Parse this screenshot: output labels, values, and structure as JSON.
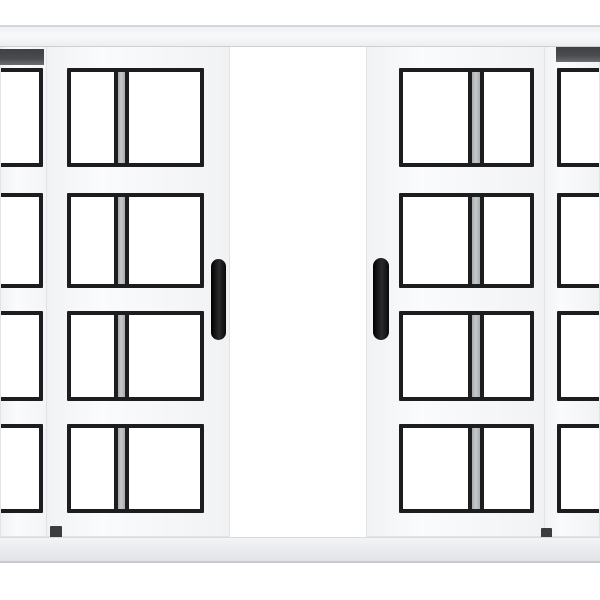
{
  "scene": {
    "kind": "product-photo",
    "description": "White aluminium four-panel sliding window with black square-grid panes, the two centre panels slid open leaving a white gap in the middle",
    "background": "#ffffff"
  },
  "colors": {
    "frame": "#f5f6f8",
    "frame_edge": "#e1e3e6",
    "grid": "#1d1d1f",
    "glass": "#ffffff",
    "rear_stile_gray": "#b7babd",
    "top_track_dark": "#494b4e",
    "bottom_rail_light": "#f3f4f6",
    "bottom_rail_shade": "#e1e3e6",
    "handle": "#171717"
  },
  "window": {
    "state": "open-center",
    "panel_count": 4,
    "rows_per_panel": 4,
    "cols_per_panel": 2,
    "handle_count": 2,
    "panels": [
      {
        "name": "left-outer",
        "cropped_side": "left",
        "visible_cols": 1,
        "handle": false
      },
      {
        "name": "left-inner",
        "cropped_side": null,
        "visible_cols": 2,
        "handle": true
      },
      {
        "name": "right-inner",
        "cropped_side": null,
        "visible_cols": 2,
        "handle": true
      },
      {
        "name": "right-outer",
        "cropped_side": "right",
        "visible_cols": 1,
        "handle": false
      }
    ]
  }
}
